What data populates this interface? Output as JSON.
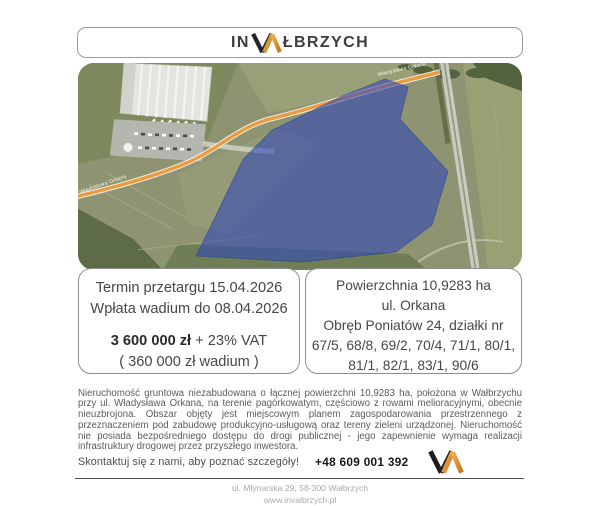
{
  "brand": {
    "prefix": "IN",
    "suffix": "ŁBRZYCH",
    "monogram": "VA",
    "accent_color": "#dd8d26",
    "text_color": "#3d3d3d"
  },
  "map": {
    "street_label": "Władysława Orkana",
    "parcel_color": "#2e45b8",
    "road_color": "#eb9b3e"
  },
  "auction_box": {
    "line1": "Termin przetargu 15.04.2026",
    "line2": "Wpłata wadium do 08.04.2026",
    "price": "3 600 000 zł",
    "price_suffix": " + 23% VAT",
    "deposit": "( 360 000 zł  wadium )"
  },
  "area_box": {
    "line1": "Powierzchnia 10,9283 ha",
    "line2": "ul. Orkana",
    "line3": "Obręb Poniatów 24, działki nr",
    "line4": "67/5, 68/8, 69/2, 70/4, 71/1, 80/1,",
    "line5": "81/1, 82/1, 83/1, 90/6"
  },
  "description": "Nieruchomość gruntowa niezabudowana o łącznej powierzchni 10,9283 ha, położona w Wałbrzychu przy ul. Władysława Orkana, na terenie pagórkowatym, częściowo z rowami melioracyjnymi, obecnie nieuzbrojona. Obszar objęty jest miejscowym planem zagospodarowania przestrzennego z przeznaczeniem pod zabudowę produkcyjno-usługową oraz tereny zieleni urządzonej. Nieruchomość nie posiada bezpośredniego dostępu do drogi publicznej - jego zapewnienie wymaga realizacji infrastruktury drogowej przez przyszłego inwestora.",
  "contact": {
    "cta": "Skontaktuj się z nami, aby poznać szczegóły!",
    "phone": "+48 609 001 392"
  },
  "footer": {
    "address": "ul. Młynarska 29, 58-300 Wałbrzych",
    "website": "www.invalbrzych.pl"
  }
}
